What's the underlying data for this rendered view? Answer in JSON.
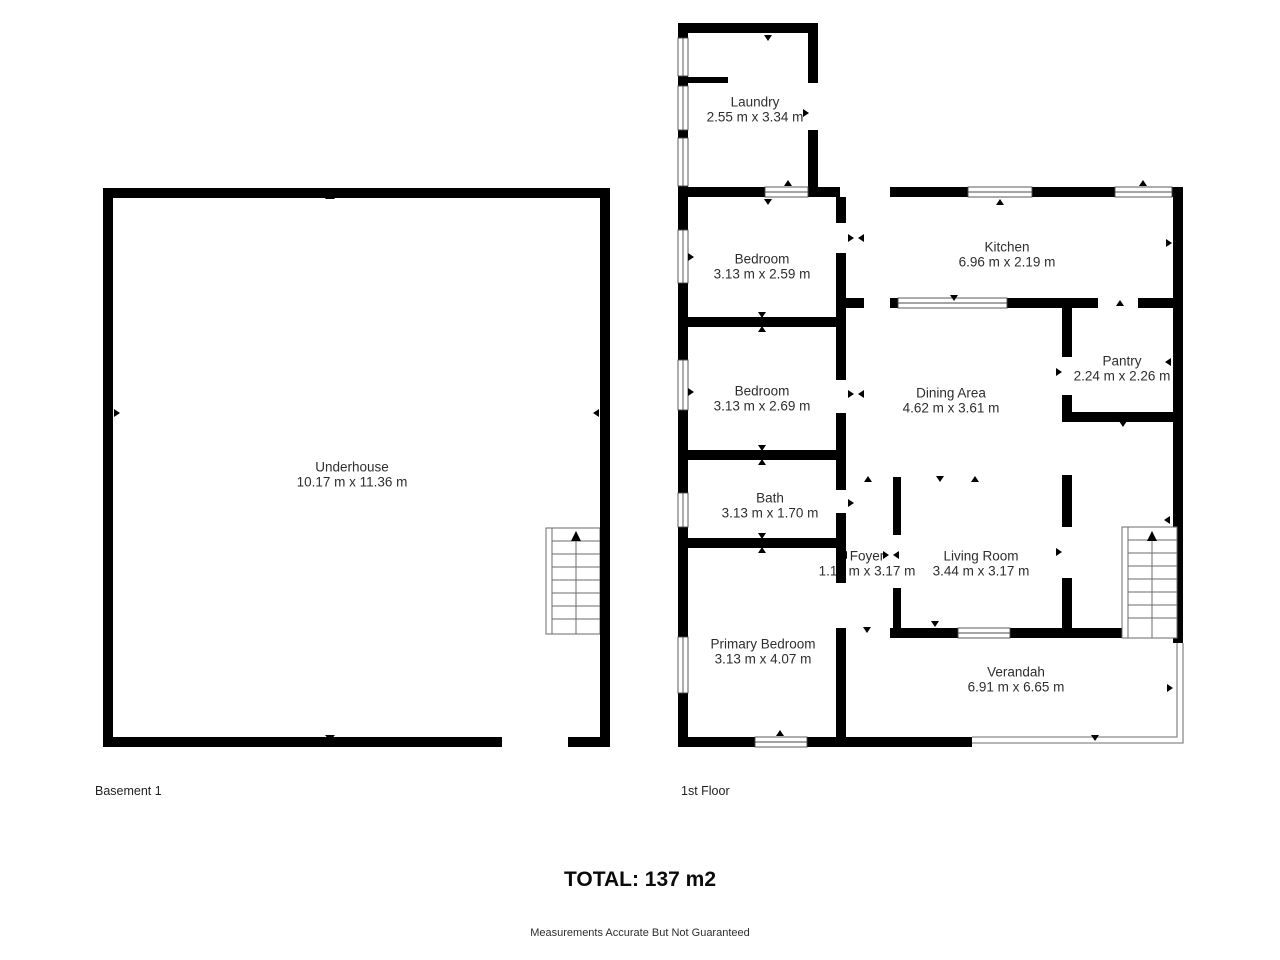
{
  "floors": [
    {
      "label": "Basement 1",
      "rooms": [
        {
          "name": "Underhouse",
          "dims": "10.17 m x 11.36 m"
        }
      ]
    },
    {
      "label": "1st Floor",
      "rooms": [
        {
          "name": "Laundry",
          "dims": "2.55 m x 3.34 m"
        },
        {
          "name": "Bedroom",
          "dims": "3.13 m x 2.59 m"
        },
        {
          "name": "Kitchen",
          "dims": "6.96 m x 2.19 m"
        },
        {
          "name": "Bedroom",
          "dims": "3.13 m x 2.69 m"
        },
        {
          "name": "Dining Area",
          "dims": "4.62 m x 3.61 m"
        },
        {
          "name": "Pantry",
          "dims": "2.24 m x 2.26 m"
        },
        {
          "name": "Bath",
          "dims": "3.13 m x 1.70 m"
        },
        {
          "name": "Foyer",
          "dims": "1.17 m x 3.17 m"
        },
        {
          "name": "Living Room",
          "dims": "3.44 m x 3.17 m"
        },
        {
          "name": "Primary Bedroom",
          "dims": "3.13 m x 4.07 m"
        },
        {
          "name": "Verandah",
          "dims": "6.91 m x 6.65 m"
        }
      ]
    }
  ],
  "total": "TOTAL: 137 m2",
  "disclaimer": "Measurements Accurate But Not Guaranteed",
  "colors": {
    "wall": "#000000",
    "text": "#2e2e2e"
  }
}
